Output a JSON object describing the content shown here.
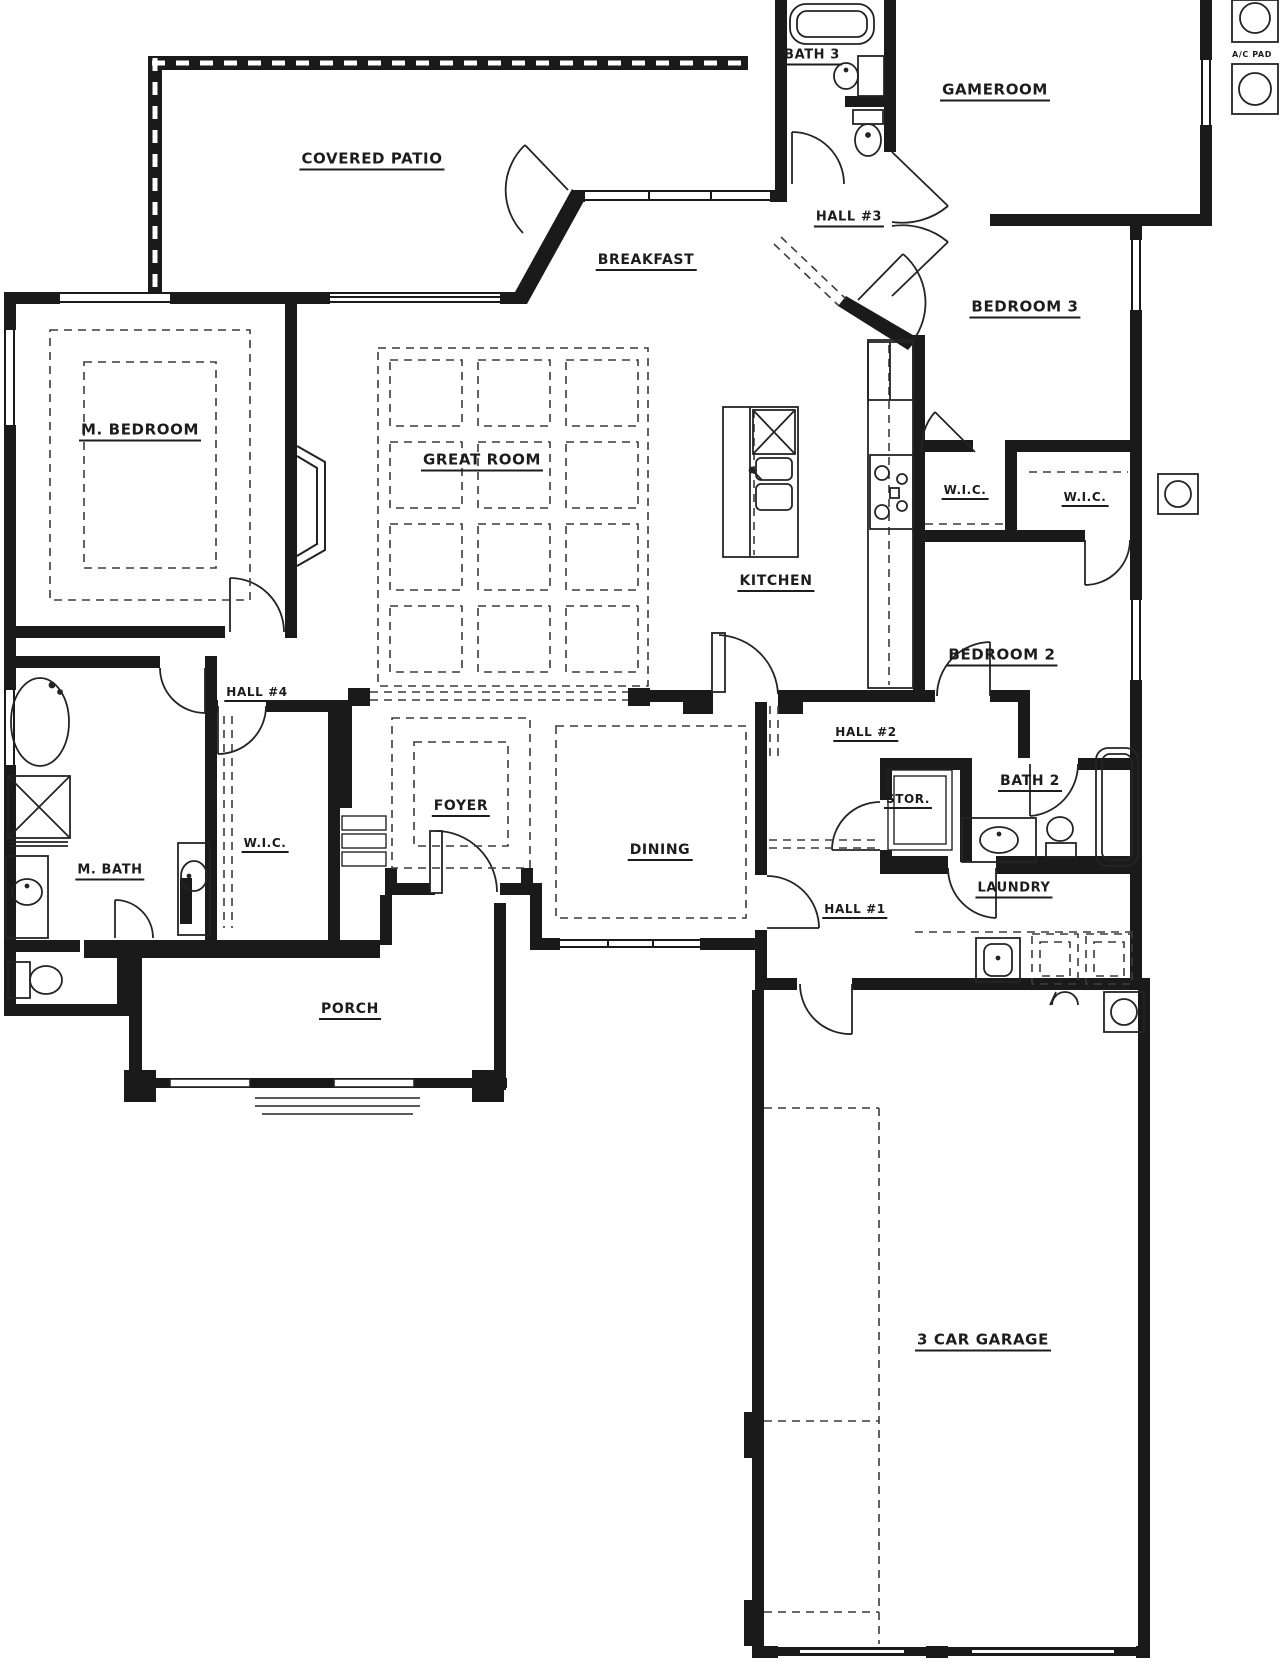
{
  "colors": {
    "wall": "#1a1a1a",
    "line": "#242424",
    "dash": "#3c3c3c",
    "bg": "#ffffff"
  },
  "rooms": [
    {
      "id": "covered-patio",
      "label": "COVERED PATIO",
      "x": 372,
      "y": 161,
      "fs": 15
    },
    {
      "id": "bath-3",
      "label": "BATH 3",
      "x": 812,
      "y": 57,
      "fs": 13
    },
    {
      "id": "gameroom",
      "label": "GAMEROOM",
      "x": 995,
      "y": 92,
      "fs": 15
    },
    {
      "id": "ac-pad",
      "label": "A/C PAD",
      "x": 1252,
      "y": 55,
      "fs": 8,
      "u": false
    },
    {
      "id": "hall-3",
      "label": "HALL #3",
      "x": 849,
      "y": 219,
      "fs": 13
    },
    {
      "id": "breakfast",
      "label": "BREAKFAST",
      "x": 646,
      "y": 262,
      "fs": 14
    },
    {
      "id": "bedroom-3",
      "label": "BEDROOM 3",
      "x": 1025,
      "y": 309,
      "fs": 15
    },
    {
      "id": "m-bedroom",
      "label": "M. BEDROOM",
      "x": 140,
      "y": 432,
      "fs": 15
    },
    {
      "id": "great-room",
      "label": "GREAT ROOM",
      "x": 482,
      "y": 462,
      "fs": 15
    },
    {
      "id": "wic-bed3",
      "label": "W.I.C.",
      "x": 965,
      "y": 492,
      "fs": 12
    },
    {
      "id": "wic-bed2",
      "label": "W.I.C.",
      "x": 1085,
      "y": 499,
      "fs": 12
    },
    {
      "id": "kitchen",
      "label": "KITCHEN",
      "x": 776,
      "y": 583,
      "fs": 14
    },
    {
      "id": "bedroom-2",
      "label": "BEDROOM 2",
      "x": 1002,
      "y": 657,
      "fs": 15
    },
    {
      "id": "hall-4",
      "label": "HALL #4",
      "x": 257,
      "y": 694,
      "fs": 12
    },
    {
      "id": "hall-2",
      "label": "HALL #2",
      "x": 866,
      "y": 734,
      "fs": 12
    },
    {
      "id": "stor",
      "label": "STOR.",
      "x": 908,
      "y": 801,
      "fs": 12
    },
    {
      "id": "foyer",
      "label": "FOYER",
      "x": 461,
      "y": 808,
      "fs": 14
    },
    {
      "id": "wic-master",
      "label": "W.I.C.",
      "x": 265,
      "y": 845,
      "fs": 12
    },
    {
      "id": "bath-2",
      "label": "BATH 2",
      "x": 1030,
      "y": 783,
      "fs": 14
    },
    {
      "id": "m-bath",
      "label": "M. BATH",
      "x": 110,
      "y": 872,
      "fs": 13
    },
    {
      "id": "dining",
      "label": "DINING",
      "x": 660,
      "y": 852,
      "fs": 14
    },
    {
      "id": "hall-1",
      "label": "HALL #1",
      "x": 855,
      "y": 911,
      "fs": 12
    },
    {
      "id": "laundry",
      "label": "LAUNDRY",
      "x": 1014,
      "y": 890,
      "fs": 13
    },
    {
      "id": "porch",
      "label": "PORCH",
      "x": 350,
      "y": 1011,
      "fs": 14
    },
    {
      "id": "garage",
      "label": "3 CAR GARAGE",
      "x": 983,
      "y": 1342,
      "fs": 15
    }
  ]
}
